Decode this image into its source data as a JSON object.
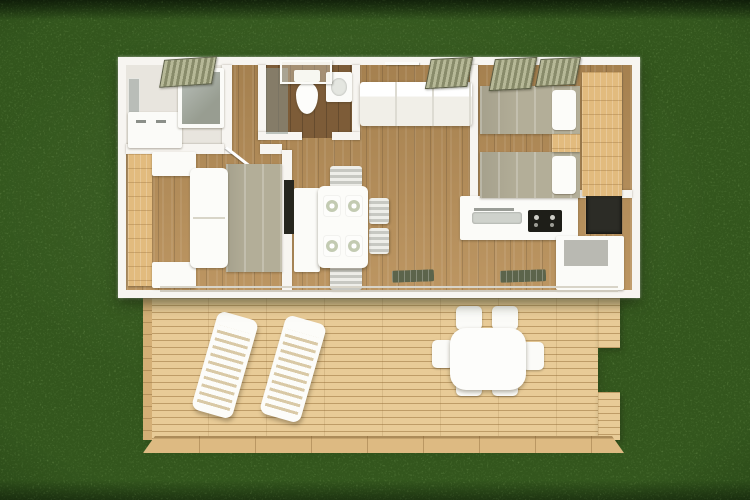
{
  "scene": {
    "label": "aerial-3d-floor-plan-render",
    "setting": "mobile home on grass lawn with attached timber deck",
    "areas": [
      "shower-room",
      "wc",
      "main-bedroom",
      "living-dining",
      "kitchen",
      "twin-bedroom",
      "deck-terrace"
    ]
  },
  "palette": {
    "grass": "#6b8f4e",
    "grass_dark": "#46652f",
    "house_wall": "#f7f5f1",
    "floor_wood": "#b88f58",
    "wc_floor": "#7d5c38",
    "deck_wood": "#e8cb97",
    "deck_line": "#c9a671",
    "furniture_white": "#fbfbf8",
    "duvet_beige": "#b3ae98",
    "wardrobe_wood": "#e2bb7e",
    "glass_gray": "#8d9790",
    "appliance_black": "#26261f",
    "shutter_olive": "#9a9c7c",
    "plate_sage": "#c3cbb2"
  },
  "objects": {
    "house": [
      "window shutters",
      "shower enclosure",
      "mirror",
      "vanity unit",
      "toilet",
      "washbasin",
      "double bed",
      "left wardrobe",
      "nightstands",
      "tv",
      "sideboard",
      "dining table with four place settings",
      "four dining chairs",
      "sofa",
      "kitchen counter",
      "sink",
      "cooktop",
      "fridge",
      "kitchen cabinets",
      "two single beds",
      "bedside table",
      "right wardrobe",
      "sliding glass doors",
      "door mats"
    ],
    "deck": [
      "two sun loungers",
      "patio table",
      "six patio chairs"
    ]
  }
}
